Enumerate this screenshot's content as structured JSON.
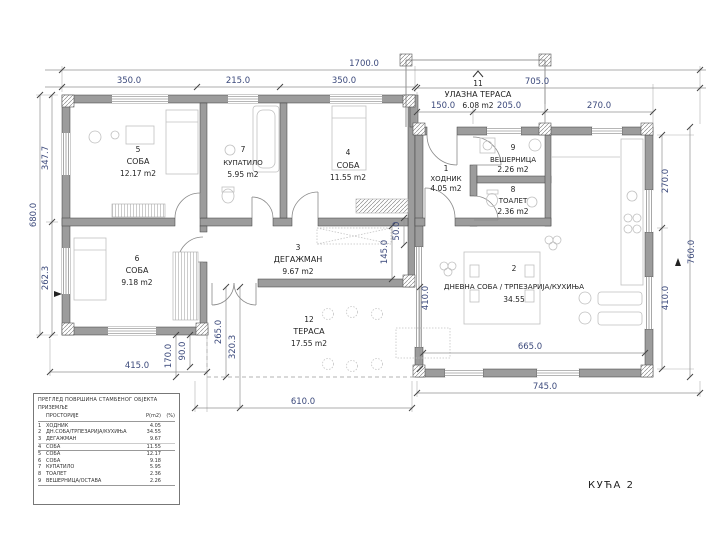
{
  "drawing_title": "КУЋА 2",
  "rooms": [
    {
      "num": "1",
      "name": "ХОДНИК",
      "area": "4.05 m2"
    },
    {
      "num": "2",
      "name": "ДНЕВНА СОБА / ТРПЕЗАРИЈА/КУХИЊА",
      "area": "34.55"
    },
    {
      "num": "3",
      "name": "ДЕГАЖМАН",
      "area": "9.67 m2"
    },
    {
      "num": "4",
      "name": "СОБА",
      "area": "11.55 m2"
    },
    {
      "num": "5",
      "name": "СОБА",
      "area": "12.17 m2"
    },
    {
      "num": "6",
      "name": "СОБА",
      "area": "9.18 m2"
    },
    {
      "num": "7",
      "name": "КУПАТИЛО",
      "area": "5.95 m2"
    },
    {
      "num": "8",
      "name": "ТОАЛЕТ",
      "area": "2.36 m2"
    },
    {
      "num": "9",
      "name": "ВЕШЕРНИЦА",
      "area": "2.26 m2"
    },
    {
      "num": "11",
      "name": "УЛАЗНА ТЕРАСА",
      "area": "6.08 m2"
    },
    {
      "num": "12",
      "name": "ТЕРАСА",
      "area": "17.55 m2"
    }
  ],
  "dimensions": {
    "top_total": "1700.0",
    "top_1": "350.0",
    "top_2": "215.0",
    "top_3": "350.0",
    "right_top_total": "705.0",
    "porch_1": "150.0",
    "porch_2": "205.0",
    "porch_3": "270.0",
    "left_outer": "680.0",
    "left_up": "347.7",
    "left_low": "262.3",
    "right_outer": "760.0",
    "right_up": "270.0",
    "right_low": "410.0",
    "bottom_left": "415.0",
    "bottom_mid": "610.0",
    "bottom_right": "745.0",
    "living_w": "665.0",
    "t_1": "170.0",
    "t_2": "90.0",
    "t_3": "265.0",
    "t_4": "320.3",
    "d_1": "145.0",
    "d_2": "50.0",
    "d_3": "410.0"
  },
  "legend_table": {
    "title": "ПРЕГЛЕД ПОВРШИНА СТАМБЕНОГ ОБЈЕКТА",
    "subtitle": "ПРИЗЕМЉЕ",
    "columns": [
      "ПРОСТОРИЈЕ",
      "P(m2)",
      "(%)"
    ],
    "rows": [
      {
        "n": "1",
        "name": "ХОДНИК",
        "area": "4.05"
      },
      {
        "n": "2",
        "name": "ДН.СОБА/ТРПЕЗАРИЈА/КУХИЊА",
        "area": "34.55"
      },
      {
        "n": "3",
        "name": "ДЕГАЖМАН",
        "area": "9.67"
      },
      {
        "n": "4",
        "name": "СОБА",
        "area": "11.55"
      },
      {
        "n": "5",
        "name": "СОБА",
        "area": "12.17"
      },
      {
        "n": "6",
        "name": "СОБА",
        "area": "9.18"
      },
      {
        "n": "7",
        "name": "КУПАТИЛО",
        "area": "5.95"
      },
      {
        "n": "8",
        "name": "ТОАЛЕТ",
        "area": "2.36"
      },
      {
        "n": "9",
        "name": "ВЕШЕРНИЦА/ОСТАВА",
        "area": "2.26"
      }
    ]
  },
  "colors": {
    "wall": "#9c9c9c",
    "dim_text": "#3c4a7c",
    "line": "#777777"
  }
}
